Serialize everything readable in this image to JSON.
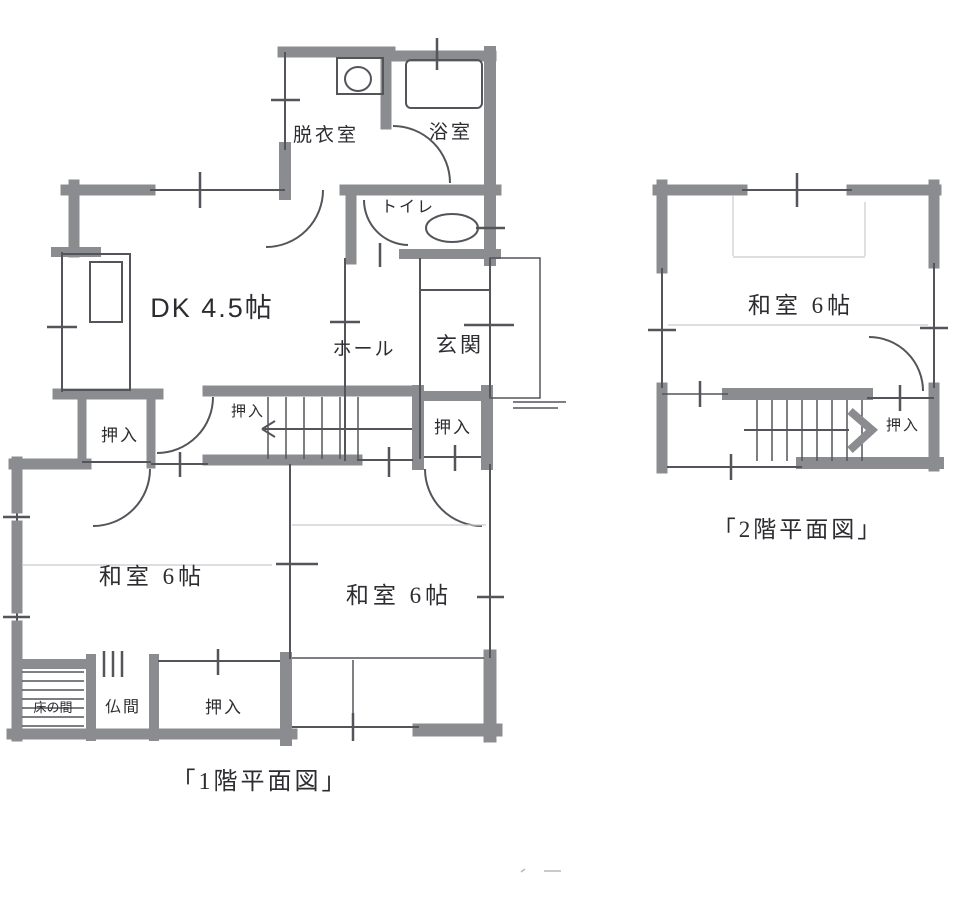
{
  "floor1": {
    "caption": "「1階平面図」",
    "rooms": {
      "dressing": "脱衣室",
      "bath": "浴室",
      "toilet": "トイレ",
      "dk": "DK 4.5帖",
      "hall": "ホール",
      "entrance": "玄関",
      "washitsu_sw": "和室 6帖",
      "washitsu_se": "和室 6帖",
      "tokonoma": "床の間",
      "butsuma": "仏間",
      "closet_dk": "押入",
      "closet_stairs": "押入",
      "closet_hall": "押入",
      "closet_south": "押入"
    }
  },
  "floor2": {
    "caption": "「2階平面図」",
    "rooms": {
      "washitsu": "和室 6帖",
      "closet": "押入"
    }
  },
  "colors": {
    "wall": "#8b8c90",
    "line": "#54555b",
    "tatami": "#c9cace",
    "text": "#2c2c31",
    "background": "#ffffff"
  }
}
